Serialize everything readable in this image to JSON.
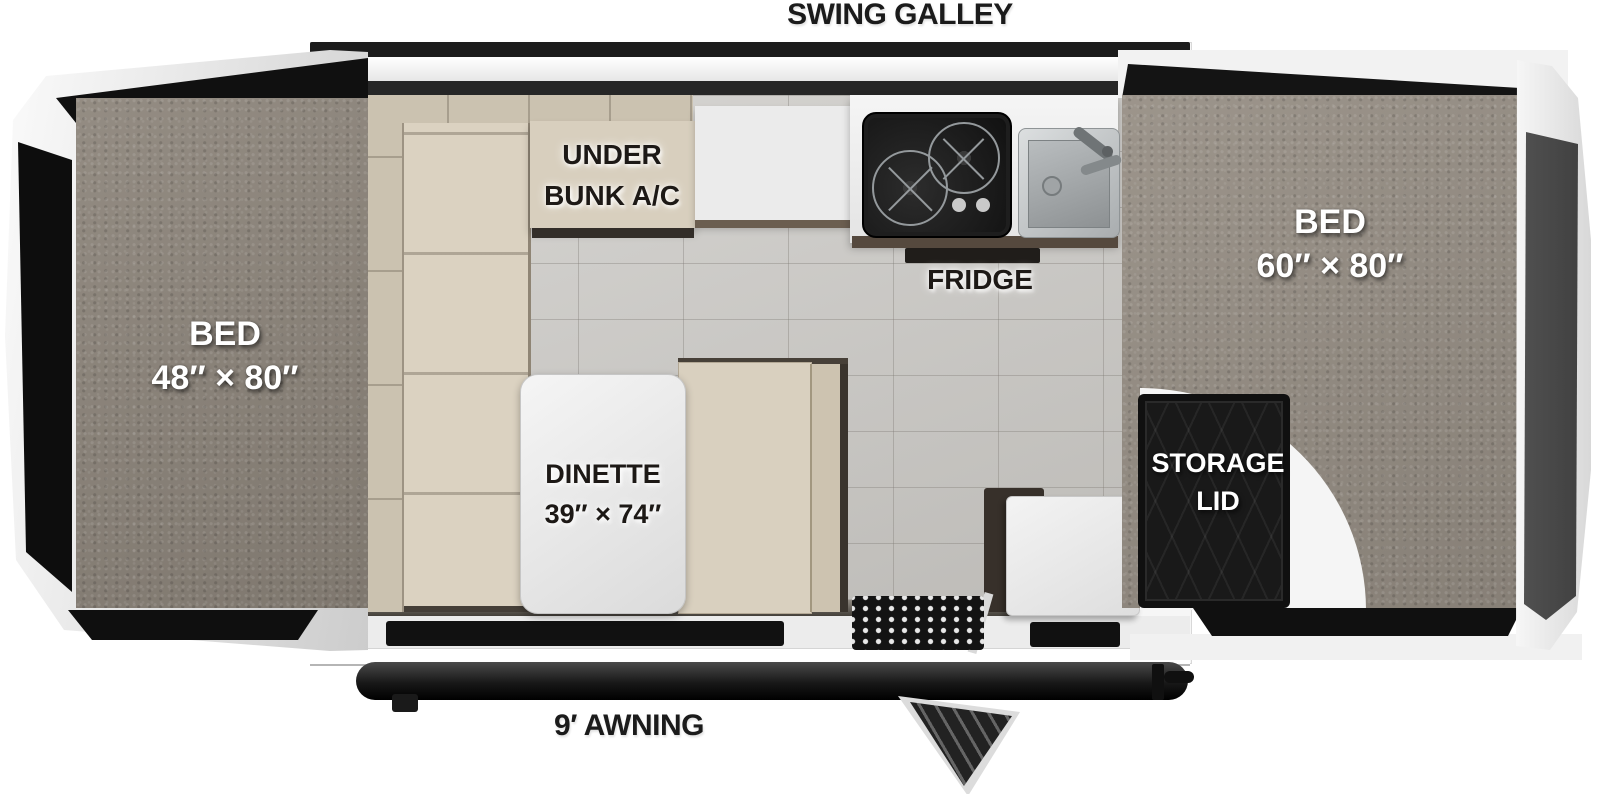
{
  "labels": {
    "swing_galley": "SWING GALLEY",
    "awning": "9′ AWNING",
    "fridge": "FRIDGE",
    "under_bunk_line1": "UNDER",
    "under_bunk_line2": "BUNK A/C",
    "storage_line1": "STORAGE",
    "storage_line2": "LID"
  },
  "beds": {
    "left": {
      "name": "BED",
      "size": "48″ × 80″"
    },
    "right": {
      "name": "BED",
      "size": "60″ × 80″"
    }
  },
  "dinette": {
    "name": "DINETTE",
    "size": "39″ × 74″"
  },
  "colors": {
    "carpet_left": "#8d857b",
    "carpet_right": "#968e84",
    "sofa_beige": "#d9d0bf",
    "tile_floor": "#c9c7c3",
    "trim_black": "#141414",
    "cap_silver": "#d9d9d9",
    "counter_white": "#efefef"
  }
}
